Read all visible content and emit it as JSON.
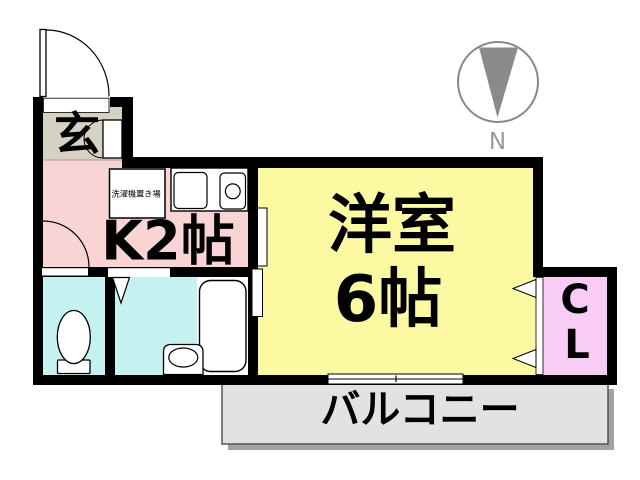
{
  "plan": {
    "title": "floor-plan",
    "rooms": {
      "genkan": {
        "label": "玄",
        "color": "#D5D1C3"
      },
      "kitchen": {
        "label": "K2帖",
        "color": "#F9D4D4"
      },
      "western_room": {
        "label_line1": "洋室",
        "label_line2": "6帖",
        "color": "#FBF9A2"
      },
      "closet": {
        "label_line1": "C",
        "label_line2": "L",
        "color": "#F8CCF5"
      },
      "toilet": {
        "color": "#C5F1F0"
      },
      "bathroom": {
        "color": "#C5F1F0"
      },
      "balcony": {
        "label": "バルコニー",
        "color": "#E2E2E2"
      }
    },
    "fixtures": {
      "washer_label": "洗濯機置き場"
    },
    "compass": {
      "label": "N",
      "arrow_color": "#8A8A8A",
      "ring_color": "#888888"
    },
    "wall_color": "#000000"
  }
}
